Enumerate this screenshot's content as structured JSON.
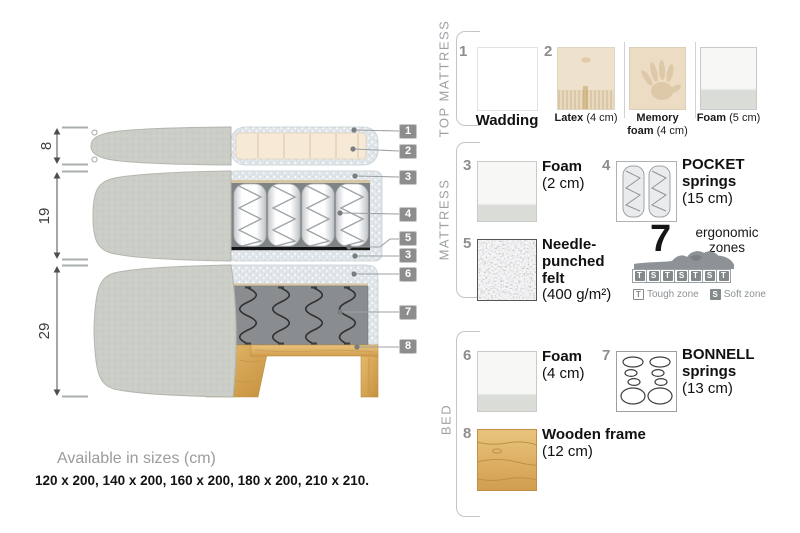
{
  "colors": {
    "tag_grey": "#8d8d8d",
    "cover_fabric": "#cbcec6",
    "wadding_speckle": "#e0e5e9",
    "latex_cream": "#f6e9d6",
    "felt_black_line": "#141414",
    "spring_box_grey": "#8a8d8f",
    "wood": "#d9a957",
    "label_grey": "#9ba1a5"
  },
  "diagram": {
    "dimensions": [
      {
        "label": "8"
      },
      {
        "label": "19"
      },
      {
        "label": "29"
      }
    ],
    "tags": [
      {
        "label": "1"
      },
      {
        "label": "2"
      },
      {
        "label": "3"
      },
      {
        "label": "4"
      },
      {
        "label": "5"
      },
      {
        "label": "3"
      },
      {
        "label": "6"
      },
      {
        "label": "7"
      },
      {
        "label": "8"
      }
    ]
  },
  "legend": {
    "top_mattress": {
      "title": "TOP MATTRESS",
      "items": [
        {
          "num": "1",
          "name": "Wadding",
          "size": ""
        },
        {
          "num": "2",
          "name": "Latex",
          "size": "(4 cm)"
        },
        {
          "num": "",
          "name": "Memory foam",
          "size": "(4 cm)"
        },
        {
          "num": "",
          "name": "Foam",
          "size": "(5 cm)"
        }
      ]
    },
    "mattress": {
      "title": "MATTRESS",
      "items": [
        {
          "num": "3",
          "name": "Foam",
          "size": "(2 cm)"
        },
        {
          "num": "4",
          "name": "POCKET springs",
          "size": "(15 cm)"
        },
        {
          "num": "5",
          "name": "Needle-punched felt",
          "size": "(400 g/m²)"
        }
      ],
      "ergonomic": {
        "count": "7",
        "caption": "ergonomic zones",
        "zones": [
          "T",
          "S",
          "T",
          "S",
          "T",
          "S",
          "T"
        ],
        "key_tough_letter": "T",
        "key_tough": "Tough zone",
        "key_soft_letter": "S",
        "key_soft": "Soft zone"
      }
    },
    "bed": {
      "title": "BED",
      "items": [
        {
          "num": "6",
          "name": "Foam",
          "size": "(4 cm)"
        },
        {
          "num": "7",
          "name": "BONNELL springs",
          "size": "(13 cm)"
        },
        {
          "num": "8",
          "name": "Wooden frame",
          "size": "(12 cm)"
        }
      ]
    }
  },
  "footer": {
    "availability": "Available in sizes (cm)",
    "sizes": "120 x 200, 140 x 200, 160 x 200, 180 x 200, 210 x 210."
  }
}
